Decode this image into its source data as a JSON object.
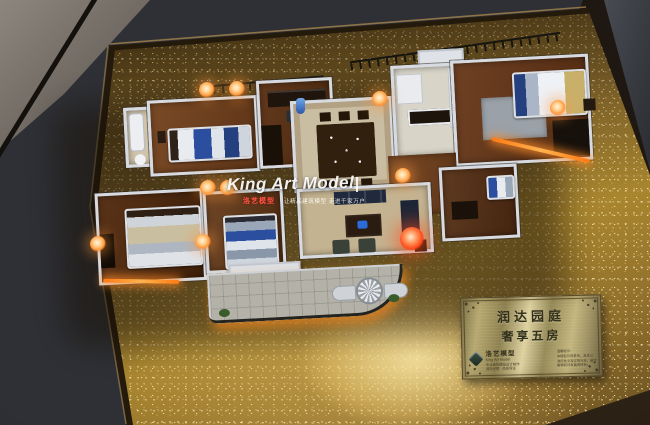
{
  "watermark": {
    "title": "King Art Model",
    "badge": "洛艺模型",
    "slogan": "让精品建筑模型 走进千家万户"
  },
  "plaque": {
    "title_line1": "润达园庭",
    "title_line2": "奢享五房",
    "brand_cn": "洛艺模型",
    "brand_en": "King Art Model",
    "left_lines": [
      "专业建筑模型设计制作",
      "诚信经营 · 品质保证"
    ],
    "right_lines": [
      "温馨提示：",
      "本模型仅供参考，具体以",
      "政府批文及实物为准，最终",
      "解释权归发展商所有。"
    ]
  },
  "colors": {
    "gold_base": "#8a6c2f",
    "frame_bronze": "#7c5e38",
    "led_accent": "#ff8c1e",
    "lamp_glow": "#ffb066",
    "plaque_brass": "#c9bc82",
    "bed_blue": "#2b4f9e",
    "background_floor": "#3a3d44"
  }
}
